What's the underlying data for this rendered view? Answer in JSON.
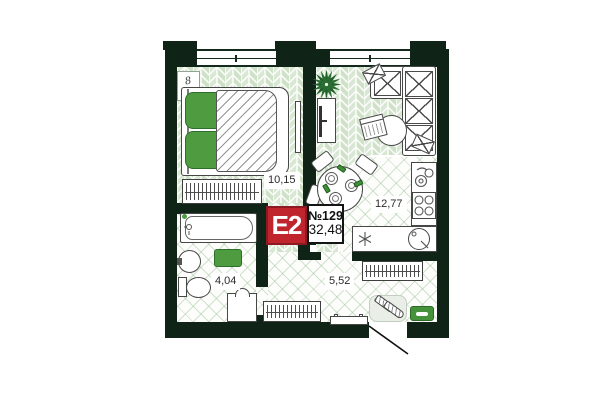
{
  "floor_plan": {
    "badge": {
      "unit_type": "E2",
      "unit_number": "№129",
      "total_area": "32,48"
    },
    "rooms": [
      {
        "name": "bedroom",
        "area": "10,15",
        "items": [
          "window",
          "bed",
          "pillows",
          "duvet",
          "wardrobe",
          "mirror",
          "corner-mark"
        ]
      },
      {
        "name": "living-kitchen",
        "area": "12,77",
        "items": [
          "window",
          "plant",
          "tv-stand",
          "corner-sofa",
          "coffee-table",
          "laptop",
          "dining-table",
          "chairs",
          "plates",
          "kitchen-sink",
          "stove",
          "round-sink",
          "kitchen-counter"
        ]
      },
      {
        "name": "bathroom",
        "area": "4,04",
        "items": [
          "bathtub",
          "wash-basin",
          "toilet",
          "washing-machine",
          "bath-mat"
        ]
      },
      {
        "name": "hallway",
        "area": "5,52",
        "items": [
          "wardrobe",
          "wardrobe",
          "bench",
          "shoe-rug",
          "shoes",
          "doormat",
          "entry-door"
        ]
      }
    ],
    "corner_mark": "8",
    "colors": {
      "wall": "#0f2316",
      "badge_red": "#c0242d",
      "floor_tile_green": "#d3e4cd",
      "accent_green": "#4f9c40"
    }
  }
}
